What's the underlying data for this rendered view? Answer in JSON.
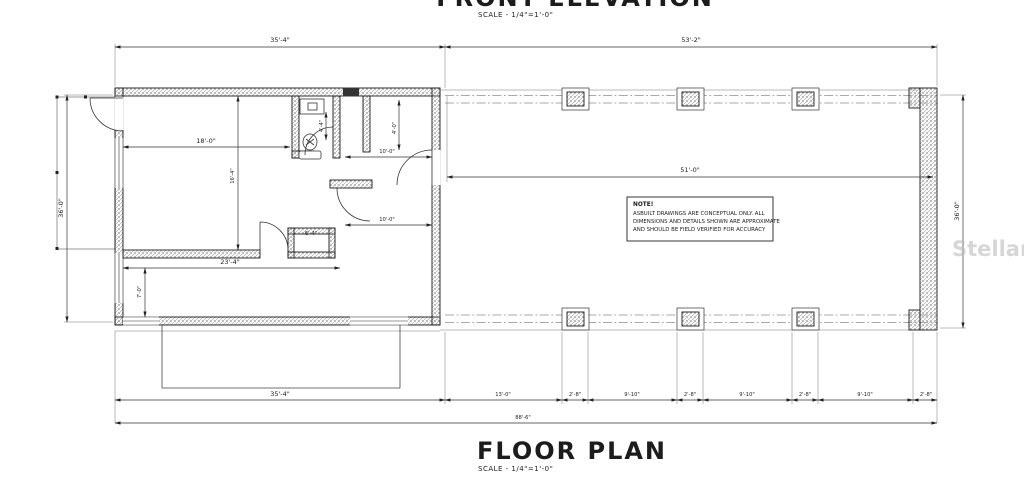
{
  "titles": {
    "front_elevation": "FRONT ELEVATION",
    "front_elevation_scale": "SCALE - 1/4\"=1'-0\"",
    "floor_plan": "FLOOR PLAN",
    "floor_plan_scale": "SCALE - 1/4\"=1'-0\""
  },
  "note": {
    "heading": "NOTE!",
    "line1": "ASBUILT DRAWINGS ARE CONCEPTUAL ONLY. ALL",
    "line2": "DIMENSIONS AND DETAILS SHOWN ARE APPROXIMATE",
    "line3": "AND SHOULD BE FIELD VERIFIED FOR ACCURACY"
  },
  "watermark": "StellarMLS",
  "dims": {
    "top_left": "35'-4\"",
    "top_right": "53'-2\"",
    "left_height": "36'-0\"",
    "right_height": "36'-0\"",
    "porch_span": "51'-0\"",
    "room_width": "18'-0\"",
    "room_height": "16'-4\"",
    "bath_width": "4'-4\"",
    "upper_opening": "10'-0\"",
    "entry_width": "4'-0\"",
    "lower_opening": "10'-0\"",
    "closet_width": "6'-4\"",
    "lower_room_width": "23'-4\"",
    "lower_room_height": "7'-0\"",
    "bottom_left": "35'-4\"",
    "bay_chain": [
      "13'-0\"",
      "2'-8\"",
      "9'-10\"",
      "2'-8\"",
      "9'-10\"",
      "2'-8\"",
      "9'-10\"",
      "2'-8\""
    ],
    "overall_width": "88'-6\""
  },
  "colors": {
    "line": "#1a1a1a",
    "hatch": "#9a9a9a",
    "watermark": "#bcbcbc",
    "background": "#ffffff"
  }
}
